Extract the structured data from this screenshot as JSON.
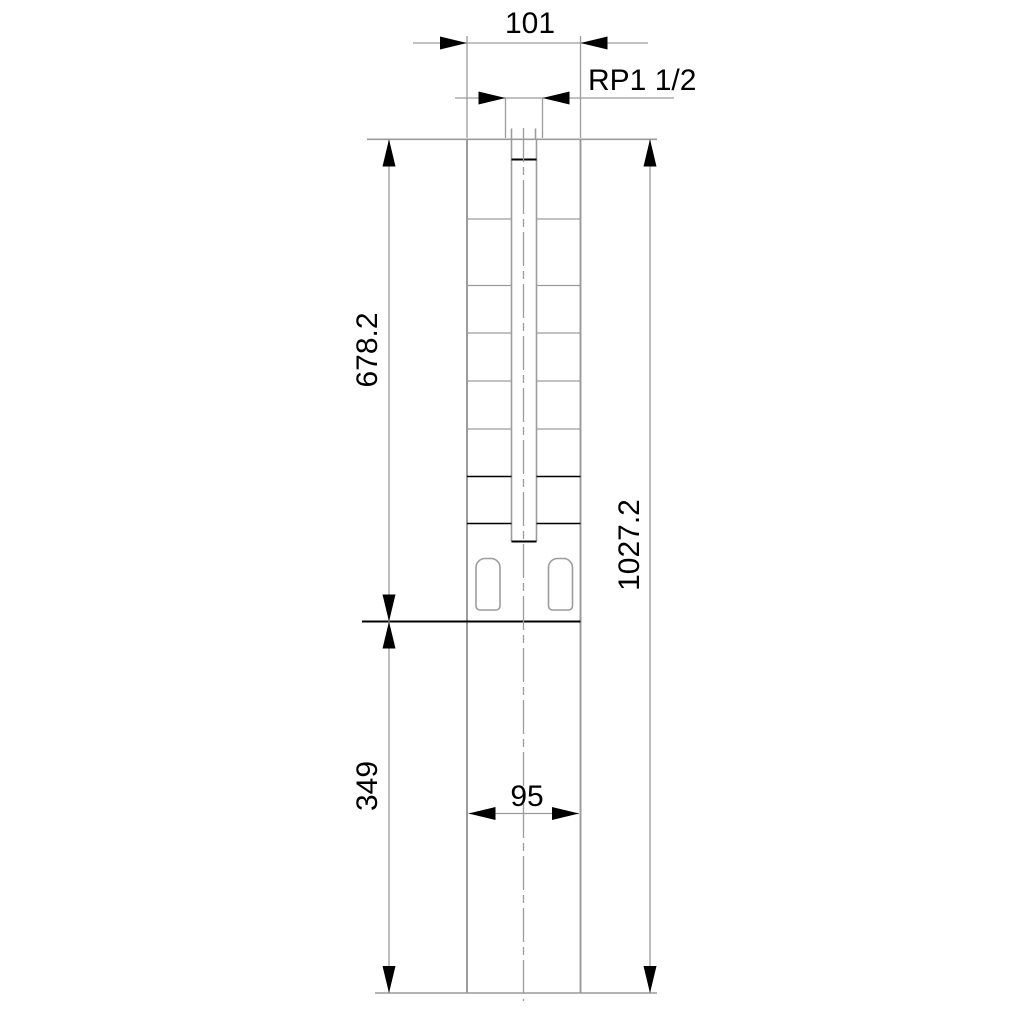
{
  "drawing": {
    "kind": "technical-dimension-drawing",
    "subject": "submersible pump outline with dimensions",
    "labels": {
      "top_width": "101",
      "thread_size": "RP1 1/2",
      "upper_section_length": "678.2",
      "lower_section_length": "349",
      "overall_length": "1027.2",
      "lower_width": "95"
    },
    "colors": {
      "line_gray": "#9c9c9c",
      "line_black": "#000000",
      "background": "#ffffff"
    }
  }
}
